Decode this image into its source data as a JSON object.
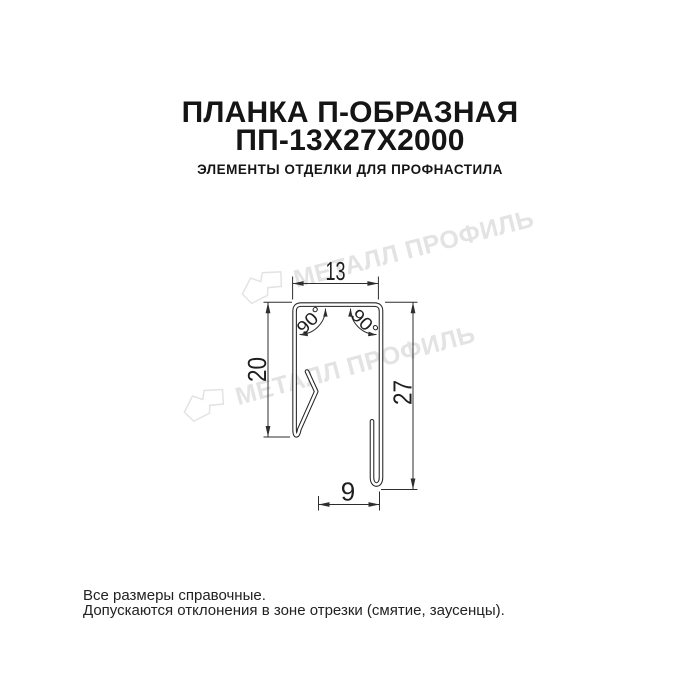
{
  "header": {
    "title_line1": "ПЛАНКА П-ОБРАЗНАЯ",
    "title_line2": "ПП-13Х27Х2000",
    "subtitle": "ЭЛЕМЕНТЫ ОТДЕЛКИ ДЛЯ ПРОФНАСТИЛА"
  },
  "watermark": {
    "text": "МЕТАЛЛ ПРОФИЛЬ",
    "color": "#e3e3e3"
  },
  "drawing": {
    "dimensions": {
      "top_width": "13",
      "left_height": "20",
      "right_height": "27",
      "bottom_width": "9",
      "angle_left": "90°",
      "angle_right": "90°"
    },
    "line_color": "#2e2e2e"
  },
  "footer": {
    "line1": "Все размеры справочные.",
    "line2": "Допускаются отклонения в зоне отрезки (смятие, заусенцы)."
  }
}
